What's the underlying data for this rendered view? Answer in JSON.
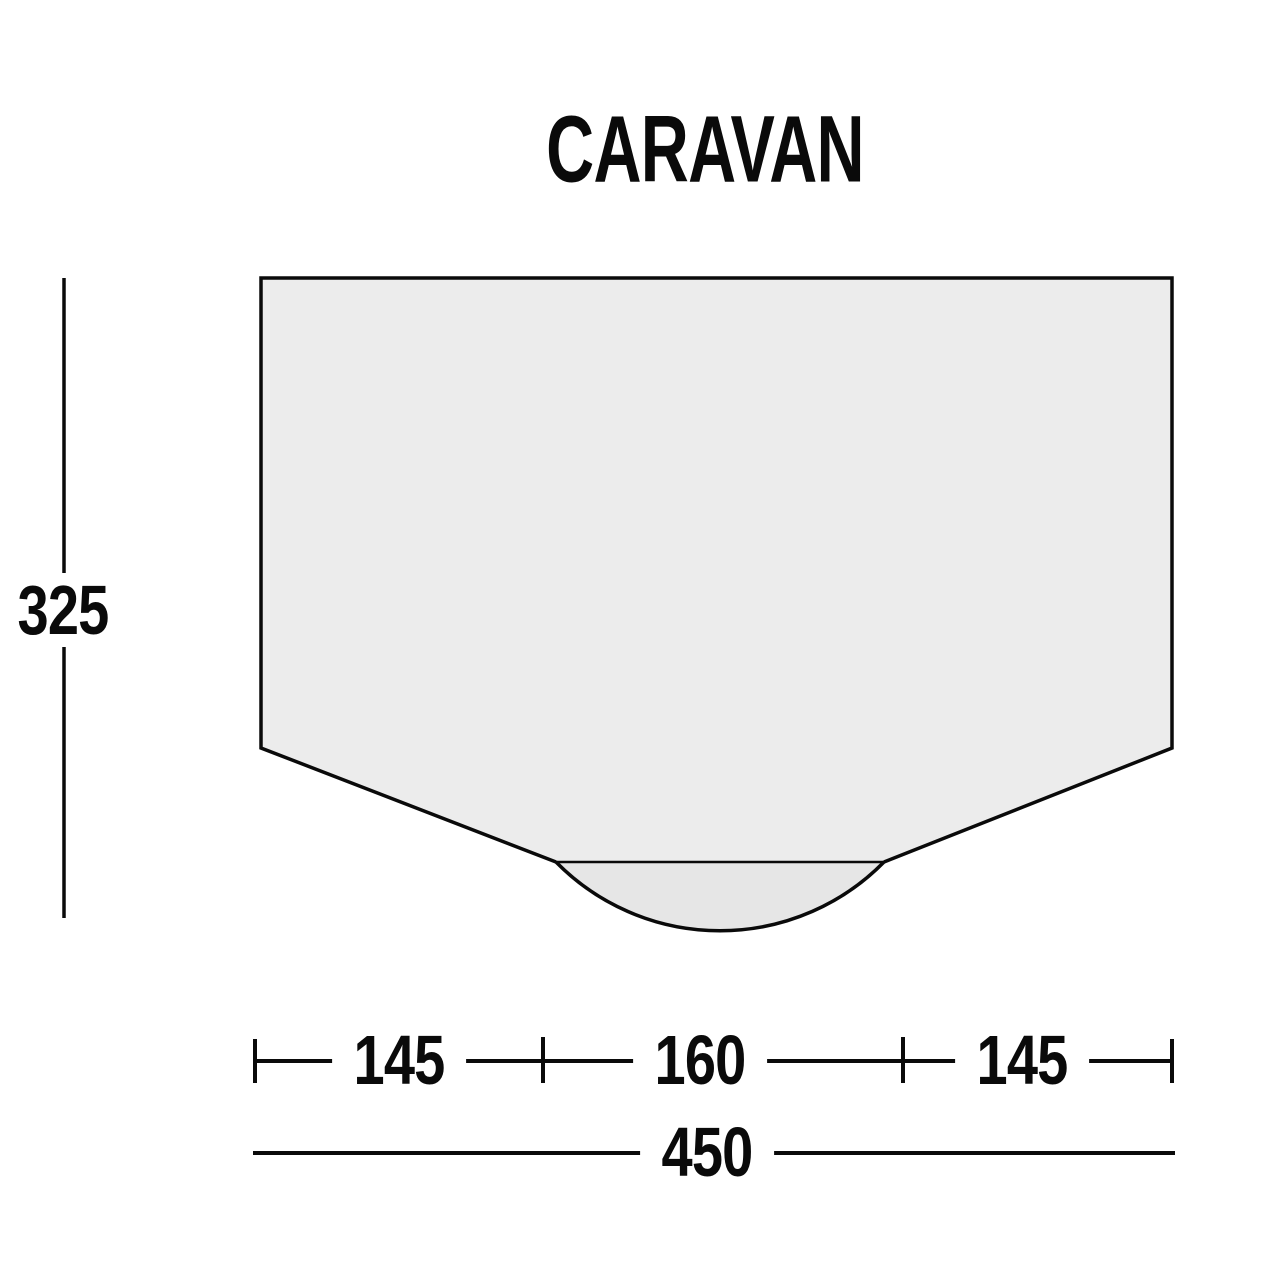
{
  "title": "CARAVAN",
  "dimension_labels": {
    "height": "325",
    "bottom_left": "145",
    "bottom_center": "160",
    "bottom_right": "145",
    "total_width": "450"
  },
  "colors": {
    "background": "#ffffff",
    "body_fill": "#ececec",
    "porch_fill": "#e6e6e6",
    "line": "#0a0a0a"
  }
}
